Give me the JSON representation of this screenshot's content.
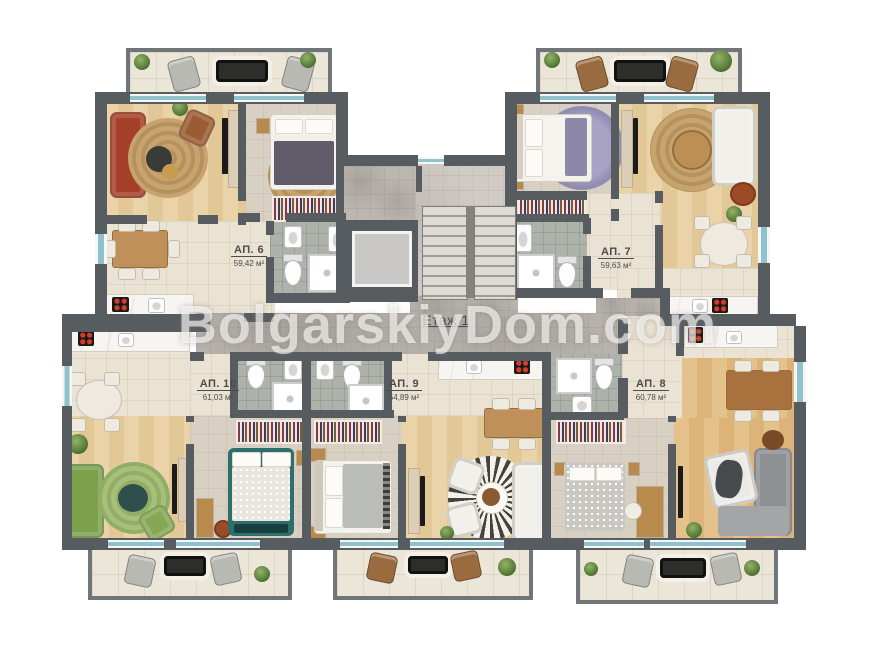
{
  "floor": {
    "label": "Етаж 1"
  },
  "watermark": {
    "text": "BolgarskiyDom.com"
  },
  "apartments": [
    {
      "label": "АП. 6",
      "area": "59,42 м²"
    },
    {
      "label": "АП. 7",
      "area": "59,63 м²"
    },
    {
      "label": "АП. 8",
      "area": "60,78 м²"
    },
    {
      "label": "АП. 9",
      "area": "54,89 м²"
    },
    {
      "label": "АП. 10",
      "area": "61,03 м²"
    }
  ],
  "colors": {
    "wall": "#575c60",
    "wood_floor": "#e6cfa0",
    "corridor_tile": "#bcb7b0",
    "bath_tile": "#adb3aa",
    "window_glass": "#8fc2cd",
    "sofa_red": "#a4402a",
    "sofa_green": "#7da24e",
    "bed_teal": "#2e6f6e"
  }
}
